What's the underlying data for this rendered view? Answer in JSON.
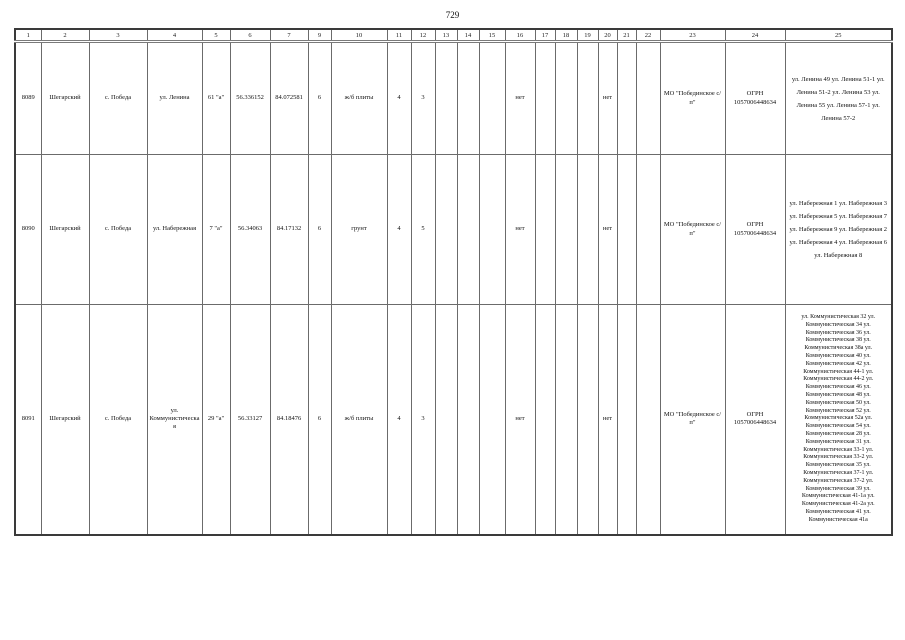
{
  "page": {
    "number": "729"
  },
  "table": {
    "header": [
      "1",
      "2",
      "3",
      "4",
      "5",
      "6",
      "7",
      "9",
      "10",
      "11",
      "12",
      "13",
      "14",
      "15",
      "16",
      "17",
      "18",
      "19",
      "20",
      "21",
      "22",
      "23",
      "24",
      "25"
    ],
    "rows": [
      {
        "cells": [
          "8089",
          "Шегарский",
          "с. Победа",
          "ул. Ленина",
          "61 \"а\"",
          "56.336152",
          "84.072581",
          "6",
          "ж/б плиты",
          "4",
          "3",
          "",
          "",
          "",
          "нет",
          "",
          "",
          "",
          "нет",
          "",
          "",
          "МО \"Побединское с/п\"",
          "ОГРН 1057006448634",
          "ул. Ленина 49 ул. Ленина 51-1 ул. Ленина 51-2 ул. Ленина 53 ул. Ленина 55 ул. Ленина 57-1 ул. Ленина 57-2"
        ]
      },
      {
        "cells": [
          "8090",
          "Шегарский",
          "с. Победа",
          "ул. Набережная",
          "7 \"а\"",
          "56.34063",
          "84.17132",
          "6",
          "грунт",
          "4",
          "5",
          "",
          "",
          "",
          "нет",
          "",
          "",
          "",
          "нет",
          "",
          "",
          "МО \"Побединское с/п\"",
          "ОГРН 1057006448634",
          "ул. Набережная 1 ул. Набережная 3 ул. Набережная 5 ул. Набережная 7 ул. Набережная 9 ул. Набережная 2 ул. Набережная 4 ул. Набережная 6 ул. Набережная 8"
        ]
      },
      {
        "cells": [
          "8091",
          "Шегарский",
          "с. Победа",
          "ул. Коммунистическая",
          "29 \"а\"",
          "56.33127",
          "84.18476",
          "6",
          "ж/б плиты",
          "4",
          "3",
          "",
          "",
          "",
          "нет",
          "",
          "",
          "",
          "нет",
          "",
          "",
          "МО \"Побединское с/п\"",
          "ОГРН 1057006448634",
          "ул. Коммунистическая 32 ул. Коммунистическая 34 ул. Коммунистическая 36 ул. Коммунистическая 38 ул. Коммунистическая 38а ул. Коммунистическая 40 ул. Коммунистическая 42 ул. Коммунистическая 44-1 ул. Коммунистическая 44-2 ул. Коммунистическая 46 ул. Коммунистическая 48 ул. Коммунистическая 50 ул. Коммунистическая 52 ул. Коммунистическая 52а ул. Коммунистическая 54 ул. Коммунистическая 28 ул. Коммунистическая 31 ул. Коммунистическая 33-1 ул. Коммунистическая 33-2 ул. Коммунистическая 35 ул. Коммунистическая 37-1 ул. Коммунистическая 37-2 ул. Коммунистическая 39 ул. Коммунистическая 41-1а ул. Коммунистическая 41-2а ул. Коммунистическая 41 ул. Коммунистическая 41а"
        ]
      }
    ]
  }
}
